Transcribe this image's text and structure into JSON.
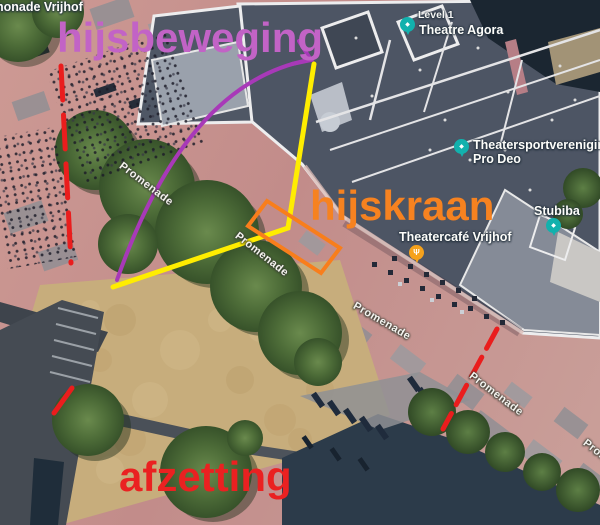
{
  "annotations": {
    "swing_text": "hijsbeweging",
    "swing_text_color": "#c263c6",
    "crane_text": "hijskraan",
    "crane_text_color": "#f68220",
    "barrier_text": "afzetting",
    "barrier_text_color": "#ea2121",
    "swing_line_color": "#ffed00",
    "swing_arc_color": "#a839b8",
    "crane_outline_color": "#f87e1c",
    "barrier_line_color": "#ea1d1d"
  },
  "map": {
    "poi": {
      "top_left_partial": "nonade Vrijhof",
      "level": "Level 1",
      "theatre_agora": "Theatre Agora",
      "theatersport_line1": "Theatersportvereniging",
      "theatersport_line2": "Pro Deo",
      "stubiba": "Stubiba",
      "theatercafe": "Theatercafé Vrijhof",
      "promenade": "Promenade"
    },
    "pins": {
      "theatre_color": "#12b1ad",
      "restaurant_color": "#f6a21c",
      "theatre_glyph": "◆",
      "restaurant_glyph": "Ψ"
    }
  }
}
